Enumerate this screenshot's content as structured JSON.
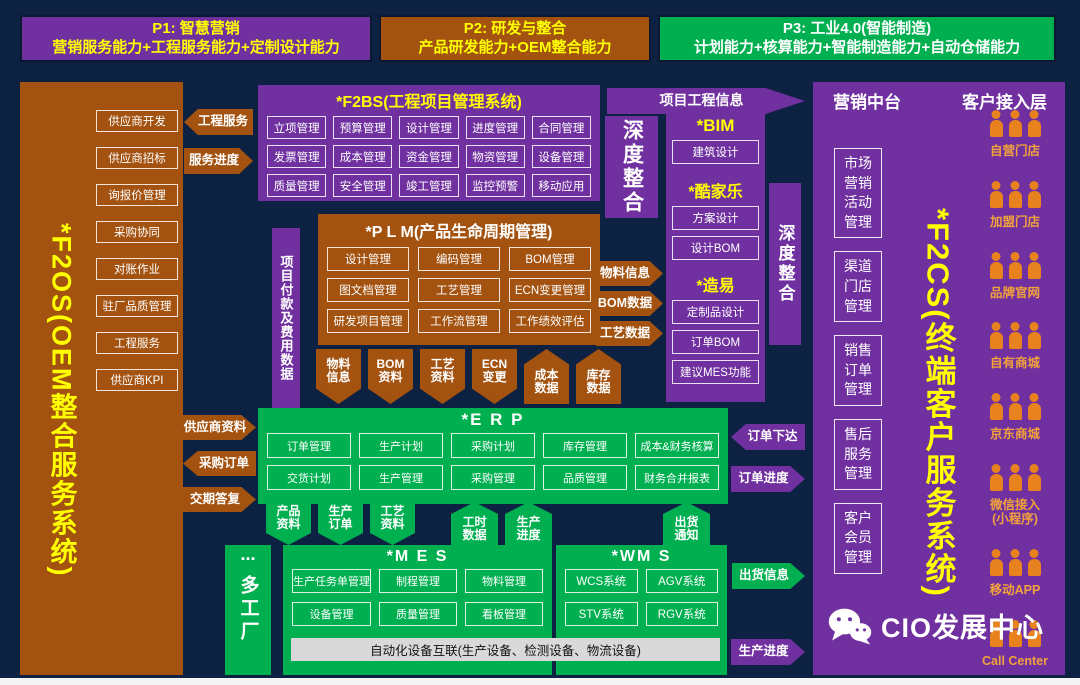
{
  "colors": {
    "purple": "#7030a0",
    "brown": "#a3520f",
    "green": "#00b050",
    "navy": "#0d2142",
    "yellow": "#ffff00",
    "person_orange": "#e8821e",
    "channel_label": "#f2a23a",
    "device_strip_bg": "#d9d9d9"
  },
  "top_bars": [
    {
      "title": "P1: 智慧营销",
      "subtitle": "营销服务能力+工程服务能力+定制设计能力",
      "theme": "purple"
    },
    {
      "title": "P2: 研发与整合",
      "subtitle": "产品研发能力+OEM整合能力",
      "theme": "brown"
    },
    {
      "title": "P3: 工业4.0(智能制造)",
      "subtitle": "计划能力+核算能力+智能制造能力+自动仓储能力",
      "theme": "green"
    }
  ],
  "f2os": {
    "title": "*F2OS(OEM整合服务系统)",
    "modules": [
      "供应商开发",
      "供应商招标",
      "询报价管理",
      "采购协同",
      "对账作业",
      "驻厂品质管理",
      "工程服务",
      "供应商KPI"
    ]
  },
  "service_arrows": [
    {
      "label": "工程服务",
      "dir": "left"
    },
    {
      "label": "服务进度",
      "dir": "right"
    }
  ],
  "f2bs": {
    "title": "*F2BS(工程项目管理系统)",
    "modules": [
      "立项管理",
      "预算管理",
      "设计管理",
      "进度管理",
      "合同管理",
      "发票管理",
      "成本管理",
      "资金管理",
      "物资管理",
      "设备管理",
      "质量管理",
      "安全管理",
      "竣工管理",
      "监控预警",
      "移动应用"
    ]
  },
  "payment_strip": {
    "label": "项目付款及费用数据"
  },
  "plm": {
    "title": "*P L M(产品生命周期管理)",
    "modules": [
      "设计管理",
      "编码管理",
      "BOM管理",
      "图文档管理",
      "工艺管理",
      "ECN变更管理",
      "研发项目管理",
      "工作流管理",
      "工作绩效评估"
    ]
  },
  "plm_erp_arrows": [
    {
      "label": "物料\n信息",
      "dir": "down"
    },
    {
      "label": "BOM\n资料",
      "dir": "down"
    },
    {
      "label": "工艺\n资料",
      "dir": "down"
    },
    {
      "label": "ECN\n变更",
      "dir": "down"
    },
    {
      "label": "成本\n数据",
      "dir": "up"
    },
    {
      "label": "库存\n数据",
      "dir": "up"
    }
  ],
  "supplier_arrows": [
    {
      "label": "供应商资料",
      "dir": "right"
    },
    {
      "label": "采购订单",
      "dir": "left"
    },
    {
      "label": "交期答复",
      "dir": "right"
    }
  ],
  "erp": {
    "title": "*E R P",
    "modules": [
      "订单管理",
      "生产计划",
      "采购计划",
      "库存管理",
      "成本&财务核算",
      "交货计划",
      "生产管理",
      "采购管理",
      "品质管理",
      "财务合并报表"
    ]
  },
  "erp_mes_down_arrows": [
    {
      "label": "产品\n资料",
      "dir": "down"
    },
    {
      "label": "生产\n订单",
      "dir": "down"
    },
    {
      "label": "工艺\n资料",
      "dir": "down"
    }
  ],
  "erp_mes_up_arrows": [
    {
      "label": "工时\n数据",
      "dir": "up"
    },
    {
      "label": "生产\n进度",
      "dir": "up"
    },
    {
      "label": "出货\n通知",
      "dir": "up"
    }
  ],
  "multi_factory": {
    "dots": "...",
    "label": "多工厂"
  },
  "mes": {
    "title": "*M E S",
    "modules": [
      "生产任务单管理",
      "制程管理",
      "物料管理",
      "设备管理",
      "质量管理",
      "看板管理"
    ]
  },
  "wms": {
    "title": "*WM S",
    "modules": [
      "WCS系统",
      "AGV系统",
      "STV系统",
      "RGV系统"
    ]
  },
  "device_strip": {
    "label": "自动化设备互联(生产设备、检测设备、物流设备)"
  },
  "project_info_arrow": {
    "label": "项目工程信息",
    "dir": "right"
  },
  "deep_integration_left": {
    "label": "深度整合"
  },
  "deep_integration_right": {
    "label": "深度整合"
  },
  "design_tools": {
    "sections": [
      {
        "title": "*BIM",
        "items": [
          "建筑设计"
        ]
      },
      {
        "title": "*酷家乐",
        "items": [
          "方案设计",
          "设计BOM"
        ]
      },
      {
        "title": "*造易",
        "items": [
          "定制品设计",
          "订单BOM",
          "建议MES功能"
        ]
      }
    ]
  },
  "data_arrows": [
    {
      "label": "物料信息",
      "dir": "right"
    },
    {
      "label": "BOM数据",
      "dir": "right"
    },
    {
      "label": "工艺数据",
      "dir": "right"
    }
  ],
  "order_arrows": [
    {
      "label": "订单下达",
      "dir": "left",
      "theme": "purple"
    },
    {
      "label": "订单进度",
      "dir": "right",
      "theme": "purple"
    },
    {
      "label": "出货信息",
      "dir": "right",
      "theme": "green"
    },
    {
      "label": "生产进度",
      "dir": "right",
      "theme": "purple"
    }
  ],
  "marketing": {
    "header": "营销中台",
    "modules": [
      "市场营销活动管理",
      "渠道门店管理",
      "销售订单管理",
      "售后服务管理",
      "客户会员管理"
    ]
  },
  "f2cs": {
    "title": "*F2CS(终端客户服务系统)"
  },
  "customer_layer": {
    "header": "客户接入层",
    "channels": [
      {
        "label": "自营门店"
      },
      {
        "label": "加盟门店"
      },
      {
        "label": "品牌官网"
      },
      {
        "label": "自有商城"
      },
      {
        "label": "京东商城"
      },
      {
        "label": "微信接入\n(小程序)"
      },
      {
        "label": "移动APP"
      },
      {
        "label": "Call Center"
      }
    ]
  },
  "watermark": {
    "label": "CIO发展中心"
  }
}
